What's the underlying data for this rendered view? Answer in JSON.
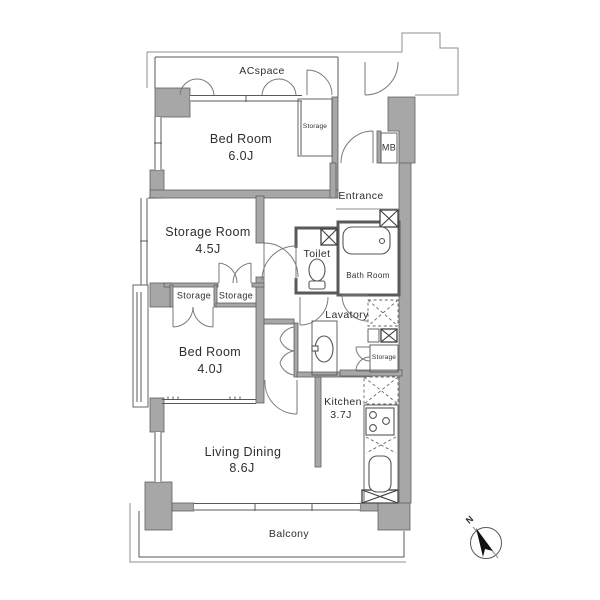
{
  "plan": {
    "rooms": {
      "acspace": {
        "name": "ACspace"
      },
      "bedroom_1": {
        "name": "Bed Room",
        "size": "6.0J"
      },
      "storage_room": {
        "name": "Storage Room",
        "size": "4.5J"
      },
      "bedroom_2": {
        "name": "Bed Room",
        "size": "4.0J"
      },
      "living_dining": {
        "name": "Living Dining",
        "size": "8.6J"
      },
      "kitchen": {
        "name": "Kitchen",
        "size": "3.7J"
      },
      "entrance": {
        "name": "Entrance"
      },
      "toilet": {
        "name": "Toilet"
      },
      "bath_room": {
        "name": "Bath Room"
      },
      "lavatory": {
        "name": "Lavatory"
      },
      "balcony": {
        "name": "Balcony"
      },
      "meter_box": {
        "name": "MB"
      }
    },
    "closets": {
      "bedroom1_storage": "Storage",
      "hall_storage_left": "Storage",
      "hall_storage_right": "Storage",
      "lavatory_storage": "Storage"
    },
    "compass": {
      "north": "N"
    },
    "colors": {
      "wall_fill": "#a7a7a7",
      "line": "#4f4f4f",
      "background": "#ffffff"
    }
  }
}
